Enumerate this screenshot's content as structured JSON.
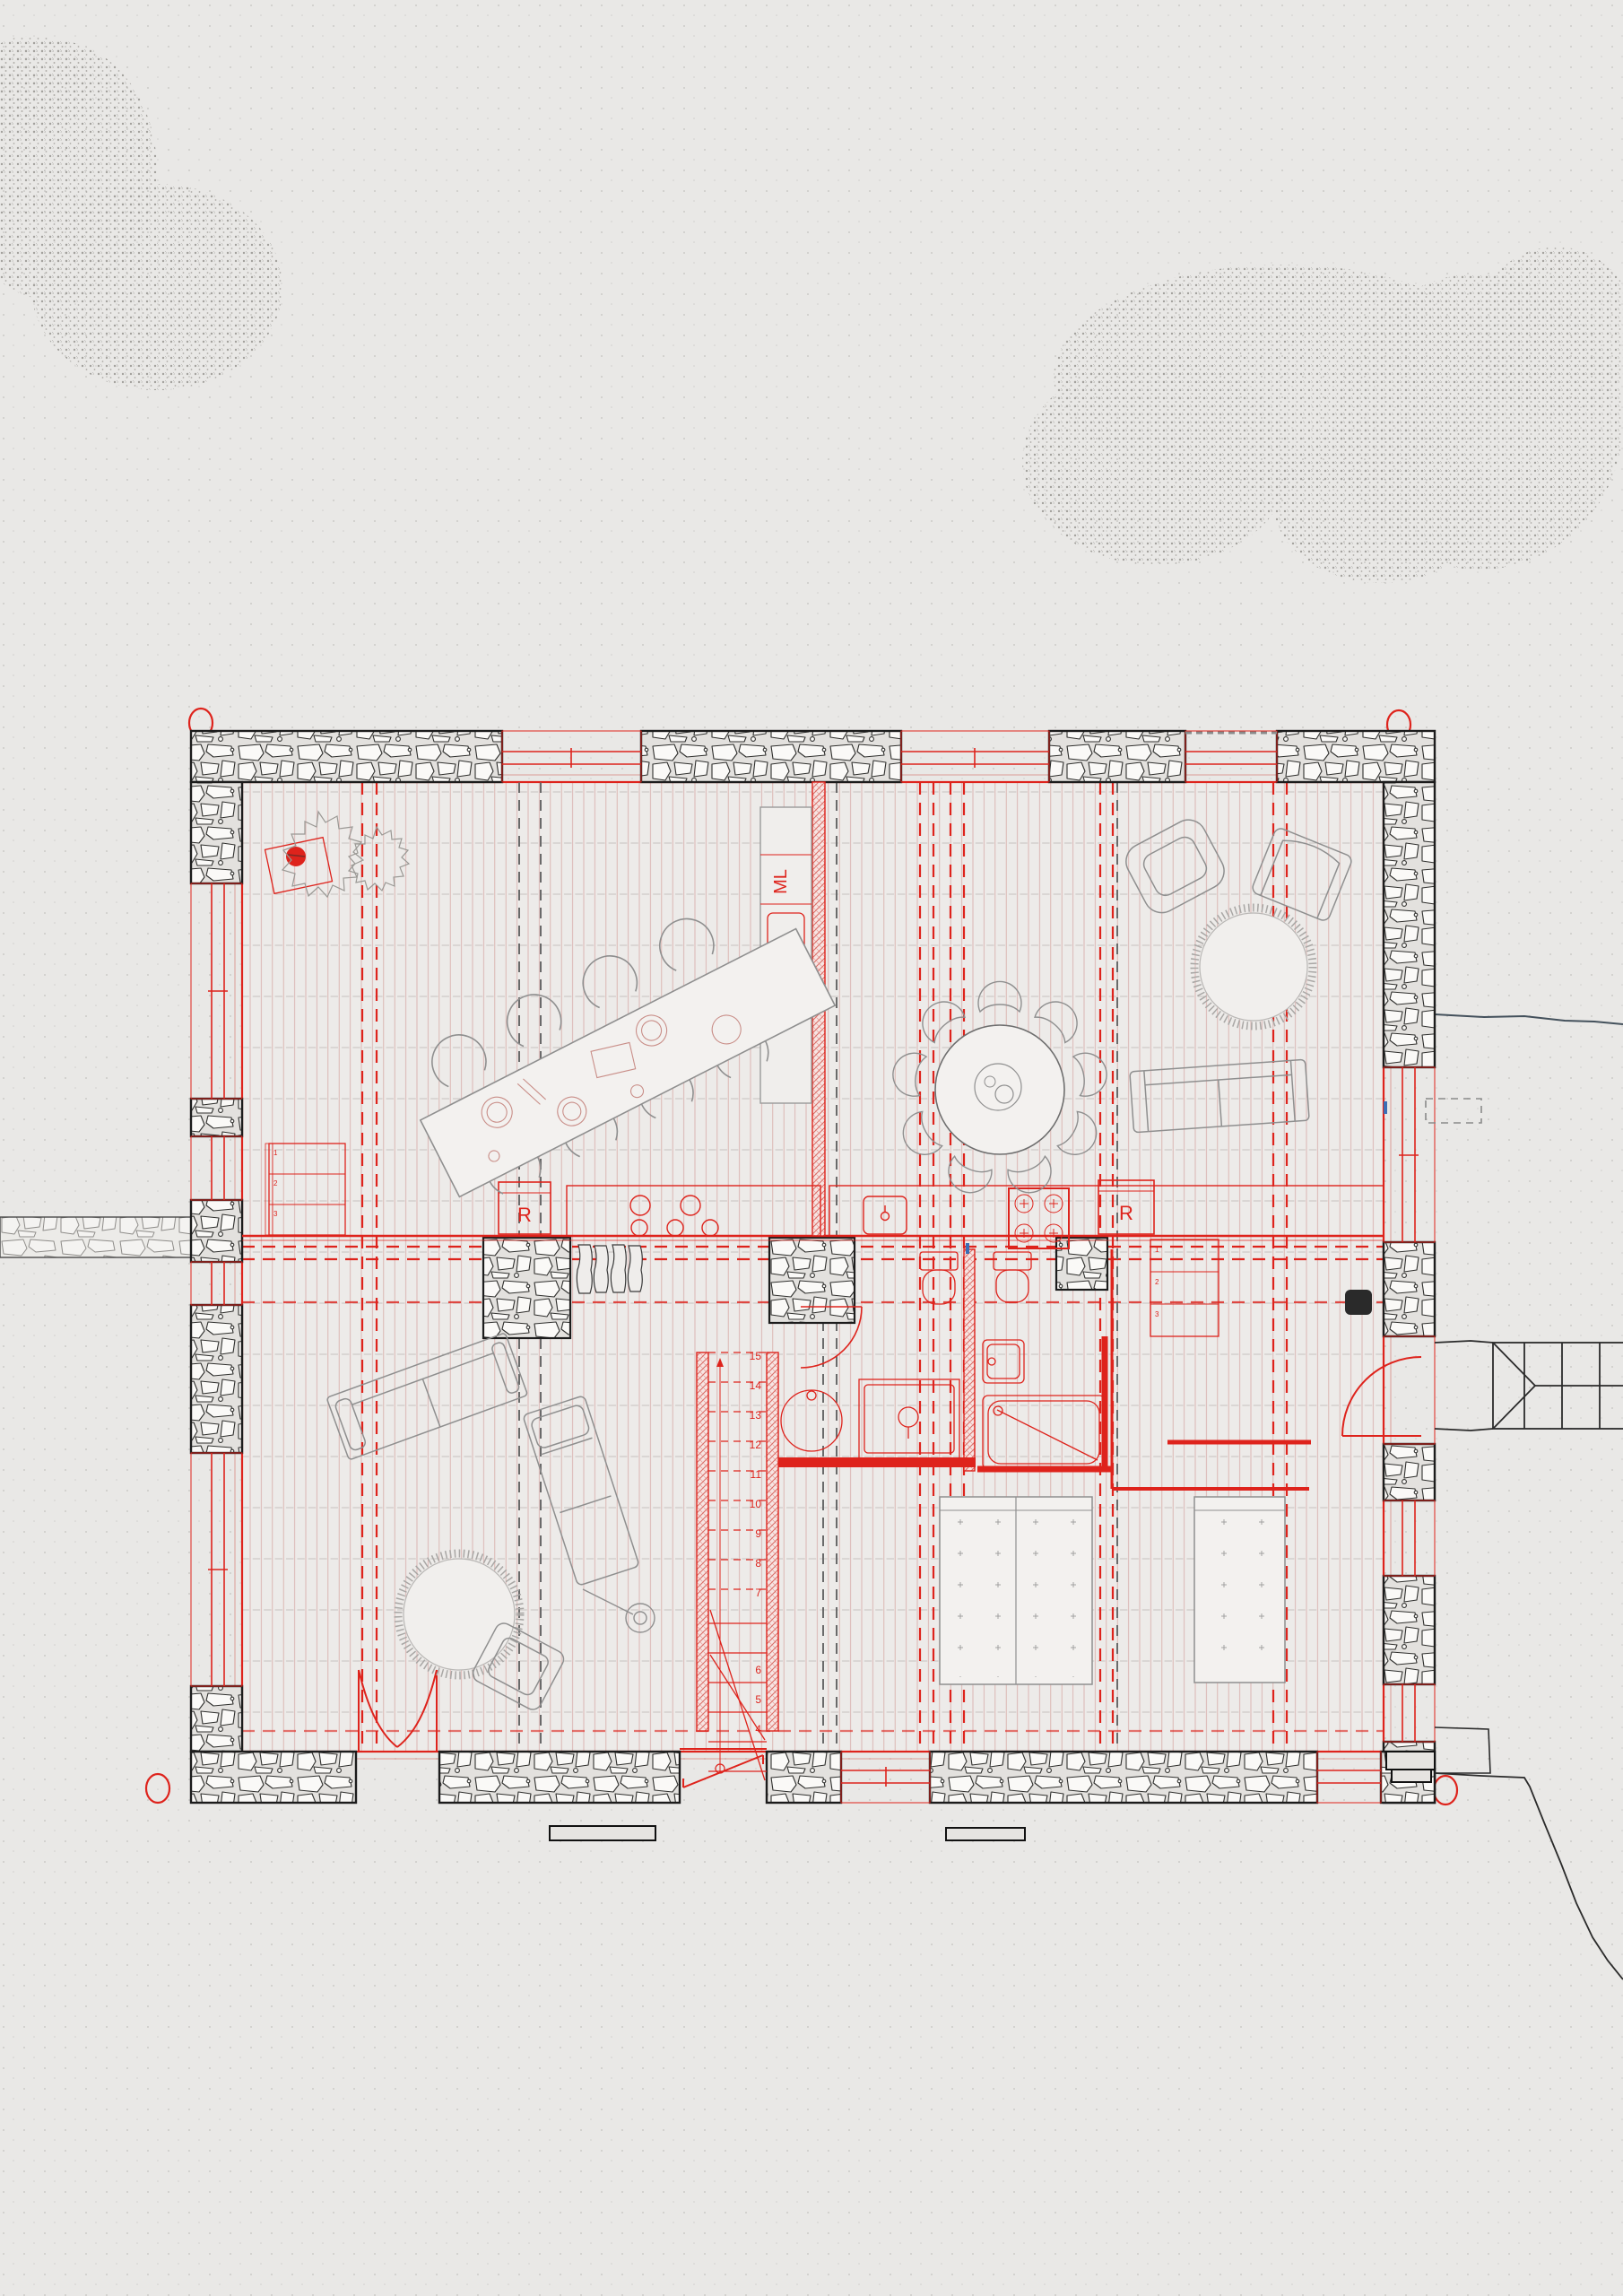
{
  "labels": {
    "washing_machine": "ML",
    "fridge_left": "R",
    "fridge_right": "R"
  },
  "stairs": {
    "numbers": [
      "15",
      "14",
      "13",
      "12",
      "11",
      "10",
      "9",
      "8",
      "7",
      "6",
      "5",
      "4"
    ]
  },
  "cabinet": {
    "shelves": [
      "1",
      "2",
      "3"
    ]
  },
  "wardrobe": {
    "shelves": [
      "1",
      "2",
      "3"
    ]
  },
  "colors": {
    "background": "#e9e8e6",
    "new_construction_red": "#de231c",
    "floor_hatch_red": "#cc8d88",
    "existing_furniture_gray": "#8f8f8f",
    "stone_outline_black": "#1c1c1c",
    "axis_gray": "#6a6a6a",
    "vegetation_gray": "#a3a19d",
    "water_line_blue": "#44515c",
    "survey_marker_red": "#de231c"
  }
}
